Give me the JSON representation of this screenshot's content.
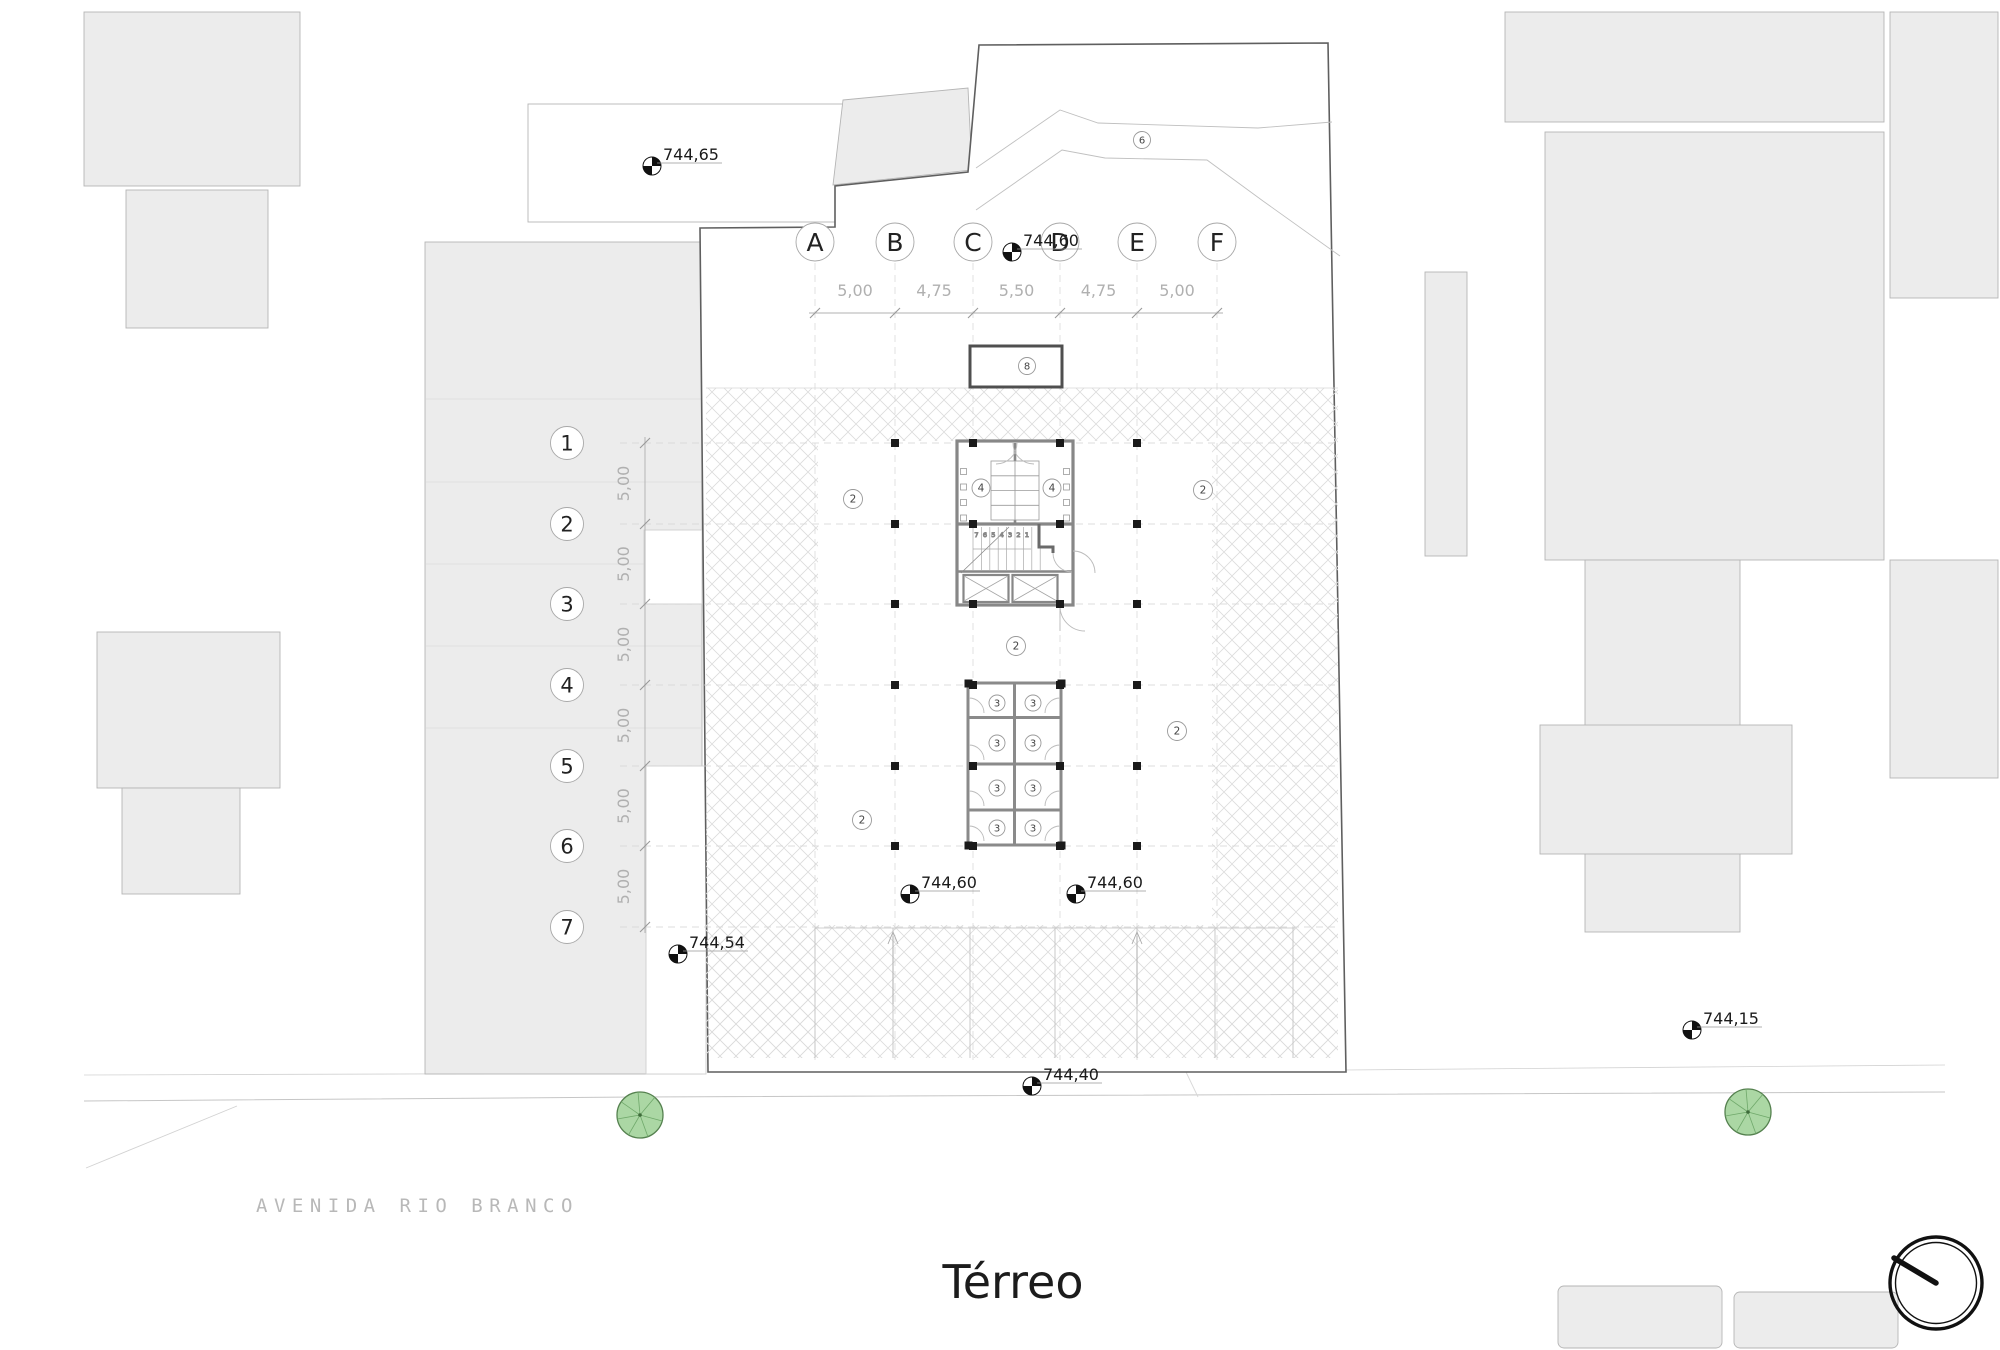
{
  "page": {
    "title": "Térreo",
    "street": "AVENIDA RIO BRANCO"
  },
  "grid": {
    "columns": [
      "A",
      "B",
      "C",
      "D",
      "E",
      "F"
    ],
    "rows": [
      "1",
      "2",
      "3",
      "4",
      "5",
      "6",
      "7"
    ],
    "column_dimensions": [
      "5,00",
      "4,75",
      "5,50",
      "4,75",
      "5,00"
    ],
    "row_dimensions": [
      "5,00",
      "5,00",
      "5,00",
      "5,00",
      "5,00",
      "5,00"
    ]
  },
  "elevations": [
    "744,65",
    "744,60",
    "744,60",
    "744,60",
    "744,54",
    "744,40",
    "744,15"
  ],
  "unit_labels": {
    "bike_rooms": [
      "4",
      "4"
    ],
    "storage_rooms": [
      "3",
      "3",
      "3",
      "3",
      "3",
      "3",
      "3",
      "3"
    ],
    "open_plan": [
      "2",
      "2",
      "2",
      "2",
      "2"
    ],
    "ramp": "6",
    "planter": "8",
    "stair_treads": "7 6 5 4 3 2 1"
  },
  "colors": {
    "tree_fill": "#abd7a4",
    "tree_stroke": "#55814f",
    "neighbor_fill": "#ececec",
    "lot_boundary": "#5f5f5f",
    "hatch": "#dcdcdc",
    "dim_text": "#b0b0b0",
    "ink": "#1a1a1a"
  }
}
